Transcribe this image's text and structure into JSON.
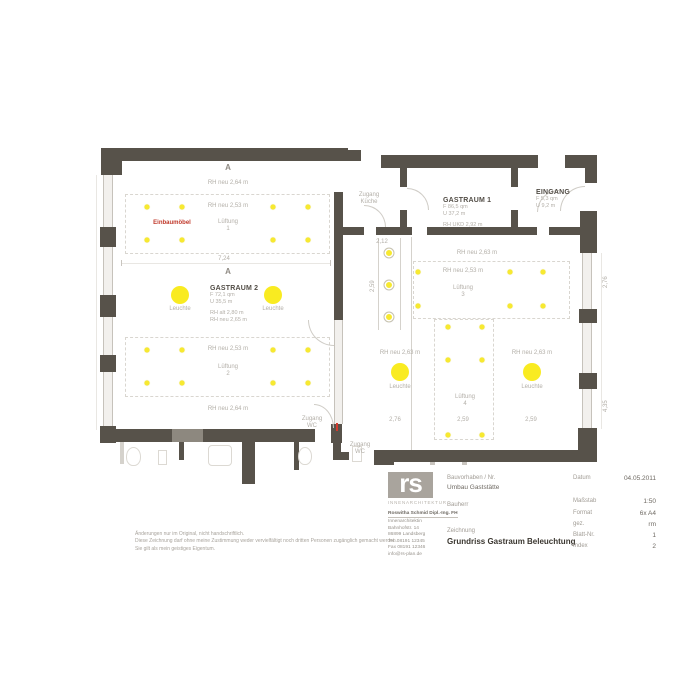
{
  "colors": {
    "wall": "#57524a",
    "wall_light": "#8d887f",
    "light_yellow": "#f7e930",
    "accent_red": "#c0392b"
  },
  "plan": {
    "section_marker": "A",
    "gastraum2": {
      "name": "GASTRAUM 2",
      "line1": "F 72,1 qm",
      "line2": "U 35,5 m",
      "line3": "RH alt 2,80 m",
      "line4": "RH neu 2,65 m"
    },
    "gastraum1": {
      "name": "GASTRAUM 1",
      "line1": "F 86,5 qm",
      "line2": "U 37,2 m",
      "line3": "RH UKD 2,92 m"
    },
    "eingang": {
      "name": "EINGANG",
      "line1": "F 5,3 qm",
      "line2": "U 9,2 m"
    },
    "labels": {
      "rh_neu_264": "RH neu 2,64 m",
      "rh_neu_253": "RH neu 2,53 m",
      "rh_neu_263": "RH neu 2,63 m",
      "lueftung": "Lüftung",
      "leuchte": "Leuchte",
      "einbaumoebel": "Einbaumöbel",
      "zugang": "Zugang",
      "kueche": "Küche",
      "wc": "WC"
    },
    "lueftung_numbers": [
      "1",
      "2",
      "3",
      "4"
    ],
    "dims": {
      "d724": "7,24",
      "d212": "2,12",
      "d259": "2,59",
      "d276": "2,76",
      "d435": "4,35"
    },
    "lights": {
      "small": [
        [
          147,
          207
        ],
        [
          182,
          207
        ],
        [
          273,
          207
        ],
        [
          308,
          207
        ],
        [
          147,
          240
        ],
        [
          182,
          240
        ],
        [
          273,
          240
        ],
        [
          308,
          240
        ],
        [
          147,
          350
        ],
        [
          182,
          350
        ],
        [
          273,
          350
        ],
        [
          308,
          350
        ],
        [
          147,
          383
        ],
        [
          182,
          383
        ],
        [
          273,
          383
        ],
        [
          308,
          383
        ],
        [
          418,
          272
        ],
        [
          510,
          272
        ],
        [
          543,
          272
        ],
        [
          418,
          306
        ],
        [
          510,
          306
        ],
        [
          543,
          306
        ],
        [
          448,
          327
        ],
        [
          482,
          327
        ],
        [
          448,
          360
        ],
        [
          482,
          360
        ],
        [
          448,
          435
        ],
        [
          482,
          435
        ]
      ],
      "large": [
        [
          180,
          295
        ],
        [
          273,
          295
        ],
        [
          400,
          372
        ],
        [
          532,
          372
        ]
      ],
      "ringed": [
        [
          389,
          253
        ],
        [
          389,
          285
        ],
        [
          389,
          317
        ]
      ]
    }
  },
  "titleblock": {
    "logo_text": "rs",
    "logo_tagline": "INNENARCHITEKTUR",
    "address_lines": [
      "Roswitha Schmid Dipl.-Ing. FH",
      "Innenarchitektin",
      "Bahnhofstr. 14",
      "86899 Landsberg",
      "Tel. 08191 12345",
      "Fax 08191 12346",
      "info@rs-plan.de"
    ],
    "bauvorhaben_label": "Bauvorhaben / Nr.",
    "bauvorhaben_value": "Umbau Gaststätte",
    "bauherr_label": "Bauherr",
    "zeichnung_label": "Zeichnung",
    "zeichnung_value": "Grundriss Gastraum Beleuchtung",
    "datum_label": "Datum",
    "datum_value": "04.05.2011",
    "massstab_label": "Maßstab",
    "massstab_value": "1:50",
    "format_label": "Format",
    "format_value": "6x A4",
    "gez_label": "gez.",
    "gez_value": "rm",
    "blatt_label": "Blatt-Nr.",
    "blatt_value": "1",
    "index_label": "Index",
    "index_value": "2"
  },
  "disclaimer": [
    "Änderungen nur im Original, nicht handschriftlich.",
    "Diese Zeichnung darf ohne meine Zustimmung weder vervielfältigt noch dritten Personen zugänglich gemacht werden.",
    "Sie gilt als mein geistiges Eigentum."
  ]
}
